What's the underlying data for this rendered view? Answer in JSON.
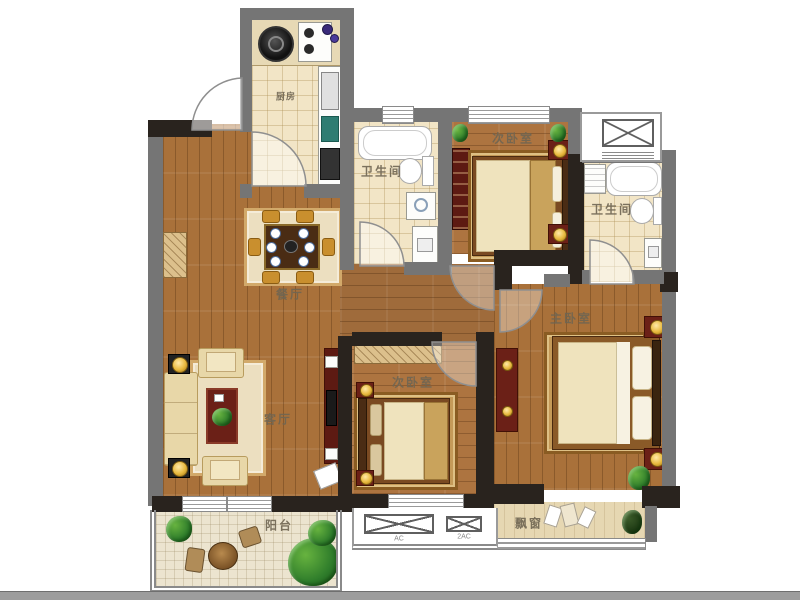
{
  "plan": {
    "rooms": {
      "kitchen": {
        "label": "厨房"
      },
      "bath_top": {
        "label": "卫生间"
      },
      "bedroom_top": {
        "label": "次卧室"
      },
      "bath_right": {
        "label": "卫生间"
      },
      "master_bedroom": {
        "label": "主卧室"
      },
      "bedroom_bottom": {
        "label": "次卧室"
      },
      "dining_room": {
        "label": "餐厅"
      },
      "living_room": {
        "label": "客厅"
      },
      "balcony": {
        "label": "阳台"
      },
      "bay_window": {
        "label": "飘窗"
      }
    },
    "platforms": {
      "ac_small": {
        "label": "AC"
      },
      "ac_large": {
        "label": "2AC"
      }
    }
  },
  "colors": {
    "wall_gray": "#757575",
    "wall_dark": "#29231e",
    "wood_floor": "#a9713a",
    "tile_floor": "#f2e5c6",
    "furniture_red": "#6b2017",
    "label_text": "#6f6552"
  }
}
